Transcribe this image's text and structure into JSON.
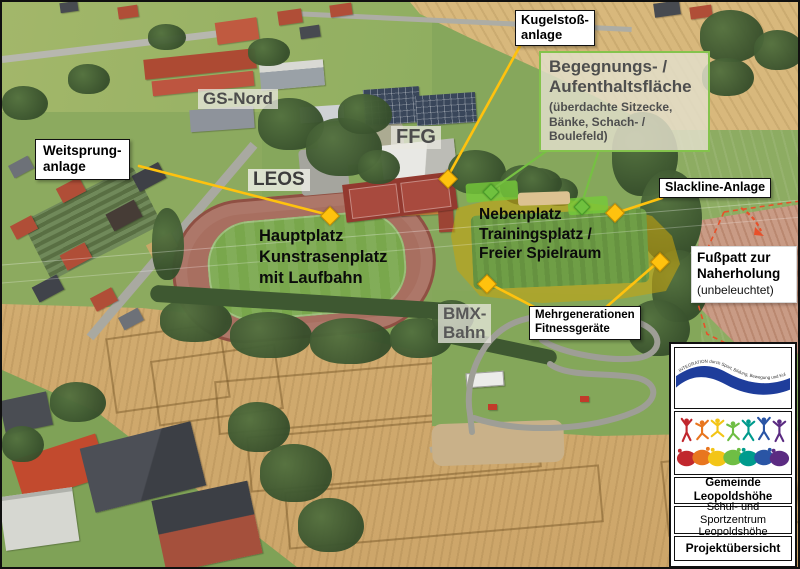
{
  "map_annotations": {
    "kugelstoss": {
      "line1": "Kugelstoß-",
      "line2": "anlage"
    },
    "weitsprung": {
      "line1": "Weitsprung-",
      "line2": "anlage"
    },
    "slackline": {
      "label": "Slackline-Anlage"
    },
    "begegnung": {
      "title1": "Begegnungs- /",
      "title2": "Aufenthaltsfläche",
      "detail1": "(überdachte Sitzecke,",
      "detail2": "Bänke, Schach- /",
      "detail3": "Boulefeld)"
    },
    "gs_nord": {
      "label": "GS-Nord"
    },
    "ffg": {
      "label": "FFG"
    },
    "leos": {
      "label": "LEOS"
    },
    "hauptplatz": {
      "line1": "Hauptplatz",
      "line2": "Kunstrasenplatz",
      "line3": "mit Laufbahn"
    },
    "nebenplatz": {
      "line1": "Nebenplatz",
      "line2": "Trainingsplatz /",
      "line3": "Freier Spielraum"
    },
    "fusspatt": {
      "line1": "Fußpatt zur",
      "line2": "Naherholung",
      "line3": "(unbeleuchtet)"
    },
    "bmx": {
      "line1": "BMX-",
      "line2": "Bahn"
    },
    "fitness": {
      "line1": "Mehrgenerationen",
      "line2": "Fitnessgeräte"
    }
  },
  "legend": {
    "tagline": "INTEGRATION durch Sport, Bildung, Bewegung und Kultur",
    "authority_line1": "Gemeinde",
    "authority_line2": "Leopoldshöhe",
    "project_line1": "Schul- und Sportzentrum",
    "project_line2": "Leopoldshöhe",
    "sheet_title": "Projektübersicht"
  },
  "colors": {
    "marker_yellow": "#ffc20e",
    "marker_green": "#6fc13e",
    "region_border_green": "#84c34c",
    "dashed_red": "#e8502a",
    "logo_blue": "#1e3d9b"
  }
}
